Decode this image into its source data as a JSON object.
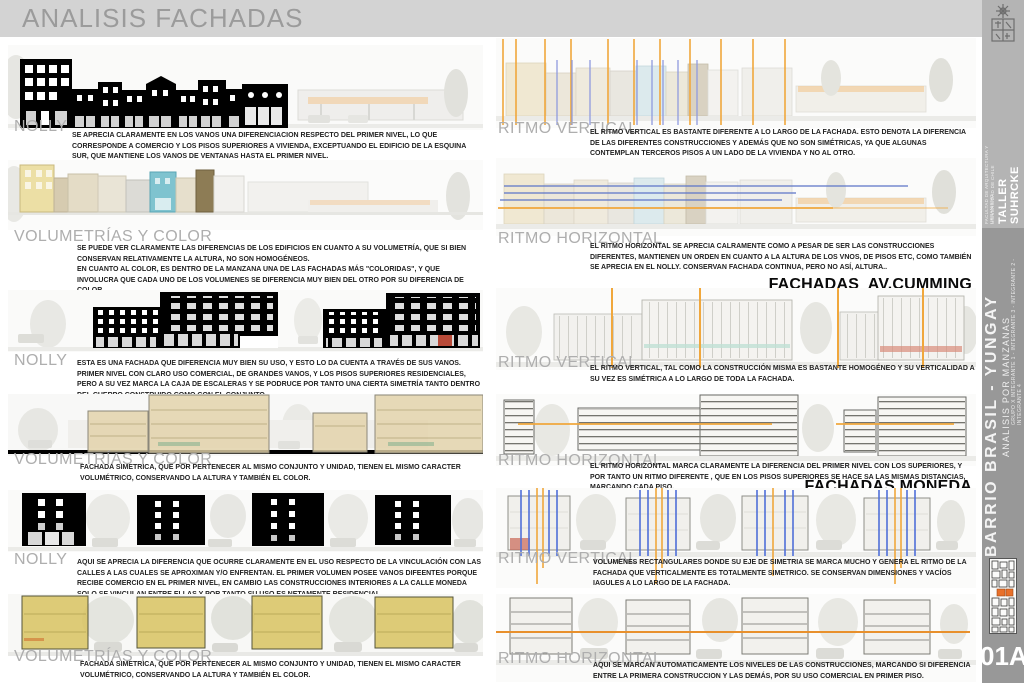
{
  "page": {
    "title": "ANALISIS FACHADAS",
    "sheet_number": "01A"
  },
  "sidebar": {
    "logo": "universidad-de-chile-crest",
    "studio": "TALLER SUHRCKE",
    "faculty": "FACULTAD DE ARQUITECTURA Y URBANISMO",
    "university": "UNIVERSIDAD DE CHILE",
    "project": "BARRIO BRASIL - YUNGAY",
    "subtitle": "ANALISIS POR MANZANAS",
    "group": "GRUPO X   INTEGRANTE 1 - INTEGRANTE 3 - INTEGRANTE 2 - INTEGRANTE 4"
  },
  "left": {
    "sections": [
      {
        "label": "NOLLY",
        "text": "SE APRECIA CLARAMENTE EN LOS VANOS UNA DIFERENCIACION RESPECTO DEL PRIMER NIVEL, LO QUE CORRESPONDE A COMERCIO Y LOS PISOS SUPERIORES A VIVIENDA, EXCEPTUANDO EL EDIFICIO DE LA ESQUINA SUR, QUE MANTIENE LOS VANOS DE VENTANAS HASTA EL PRIMER NIVEL."
      },
      {
        "label": "VOLUMETRÍAS Y COLOR",
        "text": "SE PUEDE VER CLARAMENTE LAS DIFERENCIAS DE LOS EDIFICIOS EN CUANTO A SU VOLUMETRÍA, QUE SI BIEN CONSERVAN RELATIVAMENTE LA ALTURA, NO SON HOMOGÉNEOS.\nEN CUANTO AL COLOR, ES DENTRO DE LA MANZANA UNA DE LAS FACHADAS MÁS \"COLORIDAS\", Y QUE INVOLUCRA QUE CADA UNO DE LOS VOLUMENES SE DIFERENCIA MUY BIEN DEL OTRO POR SU DIFERENCIA DE COLOR."
      },
      {
        "label": "NOLLY",
        "text": "ESTA ES UNA FACHADA QUE DIFERENCIA MUY BIEN SU USO, Y ESTO LO DA CUENTA A TRAVÉS DE SUS VANOS. PRIMER NIVEL CON CLARO USO COMERCIAL, DE GRANDES VANOS, Y LOS PISOS SUPERIORES RESIDENCIALES, PERO A SU VEZ MARCA LA CAJA DE ESCALERAS Y SE PODRUCE POR TANTO UNA CIERTA SIMETRÍA TANTO DENTRO DEL CUERPO CONSTRUIDO COMO CON EL CONJUNTO."
      },
      {
        "label": "VOLUMETRÍAS Y COLOR",
        "text": "FACHADA SIMETRICA, QUE POR PERTENECER AL MISMO CONJUNTO Y UNIDAD, TIENEN EL MISMO CARACTER VOLUMÉTRICO, CONSERVANDO LA ALTURA Y TAMBIÉN EL COLOR."
      },
      {
        "label": "NOLLY",
        "text": "AQUI SE APRECIA LA DIFERENCIA QUE OCURRE CLARAMENTE EN EL USO RESPECTO DE LA VINCULACIÓN CON LAS CALLES A LAS CUALES SE APROXIMAN Y/O ENFRENTAN. EL PRIMER VOLUMEN POSEE VANOS DIFEENTES PORQUE RECIBE COMERCIO EN EL PRIMER NIVEL, EN CAMBIO LAS CONSTRUCCIONES INTERIORES A LA CALLE MONEDA SOLO SE VINCULAN ENTRE ELLAS Y POR TANTO SU USO ES NETAMENTE RESIDENCIAL."
      },
      {
        "label": "VOLUMETRÍAS Y COLOR",
        "text": "FACHADA SIMETRICA, QUE POR PERTENECER AL MISMO CONJUNTO Y UNIDAD, TIENEN EL MISMO CARACTER VOLUMÉTRICO, CONSERVANDO LA ALTURA Y TAMBIÉN EL COLOR."
      }
    ]
  },
  "right": {
    "groups": [
      {
        "heading": "FACHADAS AV.BRASIL",
        "sections": [
          {
            "label": "RITMO VERTICAL",
            "text": "EL RITMO VERTICAL ES BASTANTE DIFERENTE A LO LARGO DE LA FACHADA. ESTO DENOTA LA DIFERENCIA DE LAS DIFERENTES CONSTRUCCIONES Y ADEMÁS QUE NO SON SIMÉTRICAS, YA QUE ALGUNAS CONTEMPLAN TERCEROS PISOS A UN LADO DE LA VIVIENDA Y NO AL OTRO."
          },
          {
            "label": "RITMO HORIZONTAL",
            "text": "EL RITMO HORIZONTAL SE APRECIA CALRAMENTE COMO A PESAR DE SER LAS CONSTRUCCIONES DIFERENTES, MANTIENEN UN ORDEN EN CUANTO A LA ALTURA DE LOS VNOS, DE PISOS ETC, COMO TAMBIÉN SE APRECIA EN EL NOLLY. CONSERVAN FACHADA CONTINUA, PERO NO ASÍ, ALTURA.."
          }
        ]
      },
      {
        "heading": "FACHADAS  AV.CUMMING",
        "sections": [
          {
            "label": "RITMO VERTICAL",
            "text": "EL RITMO VERTICAL, TAL COMO LA CONSTRUCCIÓN MISMA ES BASTANTE HOMOGÉNEO Y SU VERTICALIDAD A SU VEZ ES SIMÉTRICA A LO LARGO DE TODA LA FACHADA."
          },
          {
            "label": "RITMO HORIZONTAL",
            "text": "EL RITMO HORIZONTAL MARCA CLARAMENTE LA DIFERENCIA DEL PRIMER NIVEL CON LOS SUPERIORES, Y POR TANTO UN RITMO DIFERENTE , QUE EN LOS PISOS SUPERIORES SE HACE SA LAS MISMAS DISTANCIAS, MARCANDO CADA PISO."
          }
        ]
      },
      {
        "heading": "FACHADAS MONEDA",
        "sections": [
          {
            "label": "RITMO VERTICAL",
            "text": "VOLUMENES RECTANGULARES DONDE SU EJE DE SIMETRIA SE MARCA MUCHO Y GENERA EL RITMO DE LA FACHADA QUE VERTICALMENTE ES TOTALMENTE SIMETRICO. SE CONSERVAN DIMENSIONES Y VACÍOS IAGULES A LO LARGO DE LA FACHADA."
          },
          {
            "label": "RITMO HORIZONTAL",
            "text": "AQUI SE MARCAN AUTOMATICAMENTE LOS NIVELES DE LAS CONSTRUCCIONES, MARCANDO SI DIFERENCIA ENTRE LA PRIMERA CONSTRUCCION Y LAS DEMÁS, POR SU USO COMERCIAL EN PRIMER PISO."
          }
        ]
      }
    ]
  },
  "colors": {
    "accent_orange": "#F0A73C",
    "accent_blue_light": "#8F9BDE",
    "accent_blue": "#5B74C8",
    "header_bar_gray": "#D3D3D3",
    "sidebar_gray": "#989898",
    "sidebar_top_gray": "#B4B4B4",
    "label_gray": "#AEAEAE",
    "volumetria_yellow": "#D8C360",
    "volumetria_tan": "#E2D2A8",
    "volumetria_teal": "#7FC3CF",
    "map_highlight_orange": "#E8702A"
  }
}
